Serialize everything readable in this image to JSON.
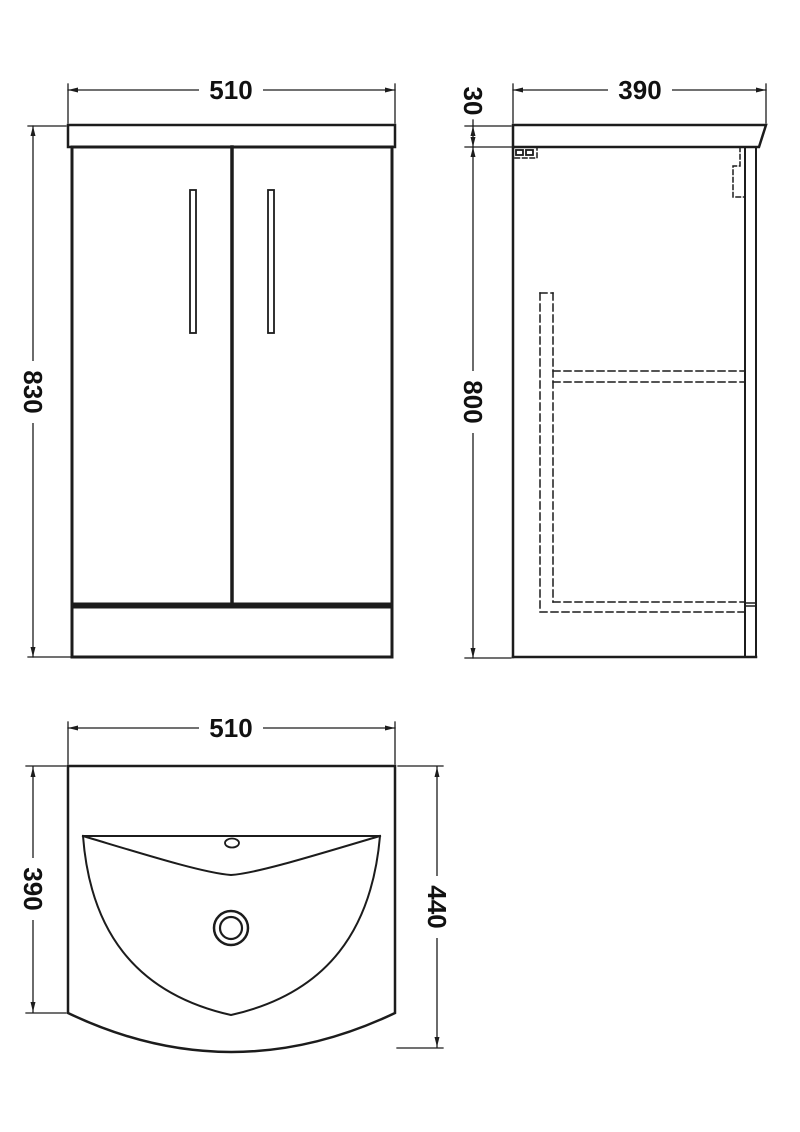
{
  "drawing": {
    "type": "technical-orthographic-drawing",
    "subject": "two-door floor-standing vanity unit with basin",
    "units": "mm",
    "line_color": "#1c1c1c",
    "background_color": "#ffffff",
    "front_view": {
      "width": "510",
      "height": "830"
    },
    "side_view": {
      "depth": "390",
      "worktop_thickness": "30",
      "carcass_height": "800"
    },
    "plan_view": {
      "width": "510",
      "basin_depth": "390",
      "overall_depth": "440"
    }
  }
}
